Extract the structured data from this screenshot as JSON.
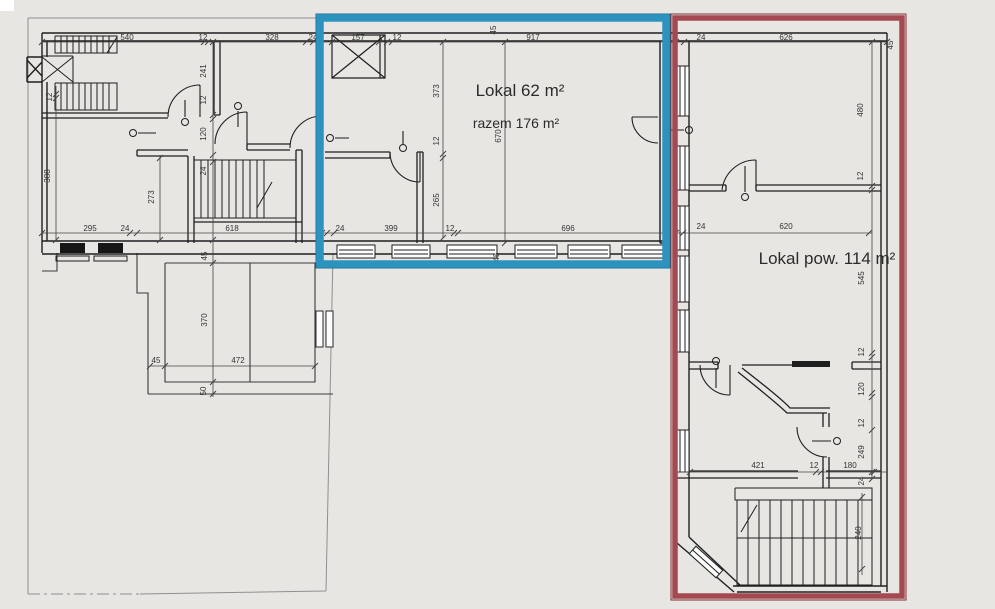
{
  "labels": {
    "lokal_blue": "Lokal 62 m²",
    "lokal_blue_total": "razem 176 m²",
    "lokal_red": "Lokal pow. 114 m²"
  },
  "colors": {
    "background": "#e8e6e2",
    "white_patch": "#ffffff",
    "wall": "#1f1f1f",
    "dim_line": "#444444",
    "boundary_gray": "#8f8f8f",
    "highlight_blue": "#2c93bf",
    "highlight_blue_edge": "#1b6e93",
    "highlight_red": "#a3494f",
    "highlight_red_edge": "#7e2f35",
    "window_fill": "#fdfdfd",
    "window_dark": "#161616"
  },
  "dimensions": [
    {
      "t": "540",
      "x": 127,
      "y": 40,
      "r": 0
    },
    {
      "t": "12",
      "x": 203,
      "y": 40,
      "r": 0
    },
    {
      "t": "328",
      "x": 272,
      "y": 40,
      "r": 0
    },
    {
      "t": "24",
      "x": 313,
      "y": 40,
      "r": 0
    },
    {
      "t": "157",
      "x": 358,
      "y": 40,
      "r": 0
    },
    {
      "t": "12",
      "x": 397,
      "y": 40,
      "r": 0
    },
    {
      "t": "917",
      "x": 533,
      "y": 40,
      "r": 0
    },
    {
      "t": "45",
      "x": 496,
      "y": 30,
      "r": -90
    },
    {
      "t": "24",
      "x": 701,
      "y": 40,
      "r": 0
    },
    {
      "t": "626",
      "x": 786,
      "y": 40,
      "r": 0
    },
    {
      "t": "45",
      "x": 893,
      "y": 45,
      "r": -90
    },
    {
      "t": "12",
      "x": 52,
      "y": 97,
      "r": -90
    },
    {
      "t": "388",
      "x": 50,
      "y": 176,
      "r": -90
    },
    {
      "t": "241",
      "x": 206,
      "y": 71,
      "r": -90
    },
    {
      "t": "12",
      "x": 206,
      "y": 100,
      "r": -90
    },
    {
      "t": "120",
      "x": 206,
      "y": 134,
      "r": -90
    },
    {
      "t": "24",
      "x": 206,
      "y": 171,
      "r": -90
    },
    {
      "t": "273",
      "x": 154,
      "y": 197,
      "r": -90
    },
    {
      "t": "373",
      "x": 439,
      "y": 91,
      "r": -90
    },
    {
      "t": "12",
      "x": 439,
      "y": 141,
      "r": -90
    },
    {
      "t": "265",
      "x": 439,
      "y": 200,
      "r": -90
    },
    {
      "t": "670",
      "x": 501,
      "y": 136,
      "r": -90
    },
    {
      "t": "295",
      "x": 90,
      "y": 231,
      "r": 0
    },
    {
      "t": "24",
      "x": 125,
      "y": 231,
      "r": 0
    },
    {
      "t": "618",
      "x": 232,
      "y": 231,
      "r": 0
    },
    {
      "t": "24",
      "x": 340,
      "y": 231,
      "r": 0
    },
    {
      "t": "399",
      "x": 391,
      "y": 231,
      "r": 0
    },
    {
      "t": "12",
      "x": 450,
      "y": 231,
      "r": 0
    },
    {
      "t": "696",
      "x": 568,
      "y": 231,
      "r": 0
    },
    {
      "t": "45",
      "x": 499,
      "y": 257,
      "r": -90
    },
    {
      "t": "480",
      "x": 863,
      "y": 110,
      "r": -90
    },
    {
      "t": "12",
      "x": 863,
      "y": 176,
      "r": -90
    },
    {
      "t": "24",
      "x": 701,
      "y": 229,
      "r": 0
    },
    {
      "t": "620",
      "x": 786,
      "y": 229,
      "r": 0
    },
    {
      "t": "545",
      "x": 864,
      "y": 278,
      "r": -90
    },
    {
      "t": "12",
      "x": 864,
      "y": 352,
      "r": -90
    },
    {
      "t": "120",
      "x": 864,
      "y": 389,
      "r": -90
    },
    {
      "t": "12",
      "x": 864,
      "y": 423,
      "r": -90
    },
    {
      "t": "249",
      "x": 864,
      "y": 452,
      "r": -90
    },
    {
      "t": "421",
      "x": 758,
      "y": 468,
      "r": 0
    },
    {
      "t": "12",
      "x": 814,
      "y": 468,
      "r": 0
    },
    {
      "t": "180",
      "x": 850,
      "y": 468,
      "r": 0
    },
    {
      "t": "24",
      "x": 864,
      "y": 481,
      "r": -90
    },
    {
      "t": "240",
      "x": 861,
      "y": 533,
      "r": -90
    },
    {
      "t": "45",
      "x": 207,
      "y": 256,
      "r": -90
    },
    {
      "t": "370",
      "x": 207,
      "y": 320,
      "r": -90
    },
    {
      "t": "45",
      "x": 156,
      "y": 363,
      "r": 0
    },
    {
      "t": "472",
      "x": 238,
      "y": 363,
      "r": 0
    },
    {
      "t": "50",
      "x": 206,
      "y": 391,
      "r": -90
    }
  ]
}
